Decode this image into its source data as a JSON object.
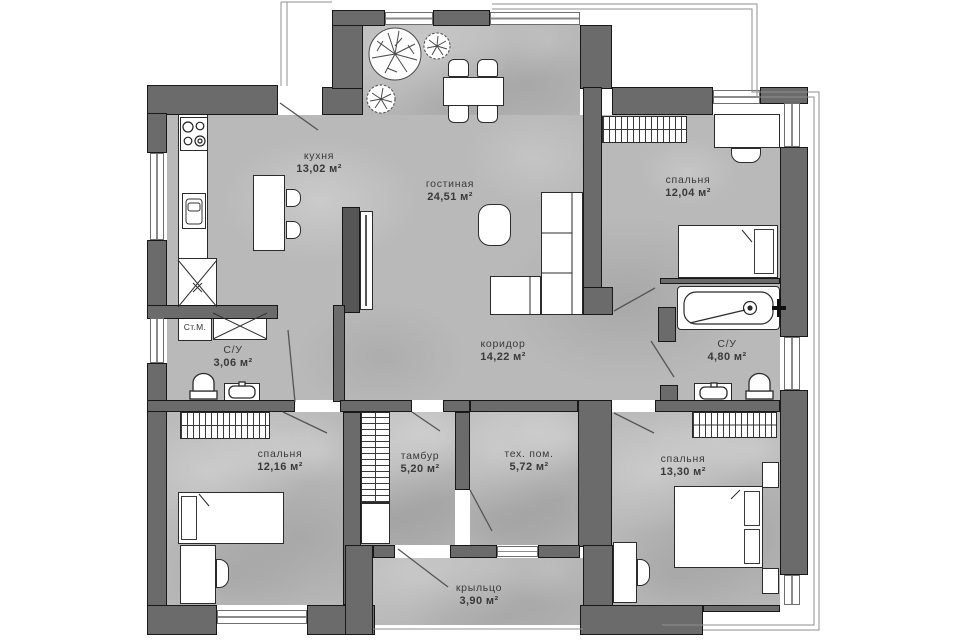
{
  "plan": {
    "rooms": [
      {
        "name": "кухня",
        "area": "13,02 м²"
      },
      {
        "name": "гостиная",
        "area": "24,51 м²"
      },
      {
        "name": "спальня",
        "area": "12,04 м²"
      },
      {
        "name": "С/У",
        "area": "3,06 м²"
      },
      {
        "name": "коридор",
        "area": "14,22 м²"
      },
      {
        "name": "С/У",
        "area": "4,80 м²"
      },
      {
        "name": "спальня",
        "area": "12,16 м²"
      },
      {
        "name": "тамбур",
        "area": "5,20 м²"
      },
      {
        "name": "тех. пом.",
        "area": "5,72 м²"
      },
      {
        "name": "спальня",
        "area": "13,30 м²"
      },
      {
        "name": "крыльцо",
        "area": "3,90 м²"
      }
    ],
    "labels": {
      "washing_machine": "Ст.М."
    },
    "colors": {
      "wall": "#6b6b6b",
      "floor": "#b9b9b9",
      "outline": "#181818"
    }
  }
}
